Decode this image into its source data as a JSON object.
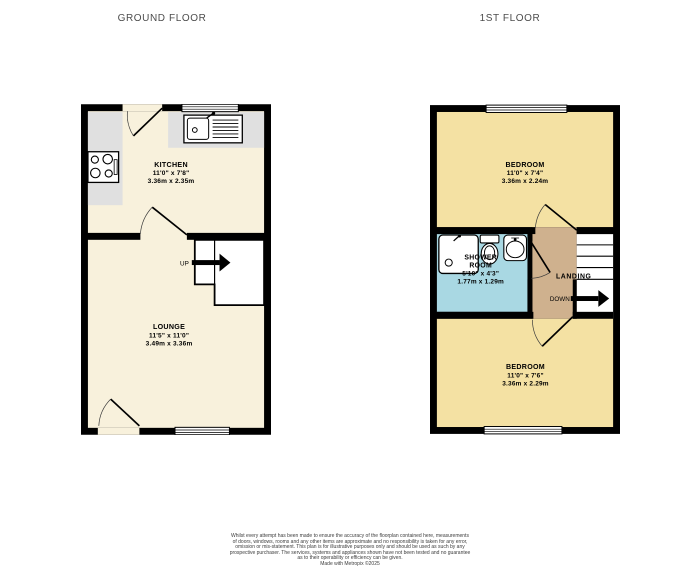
{
  "titles": {
    "ground_floor": "GROUND FLOOR",
    "first_floor": "1ST FLOOR"
  },
  "ground_floor": {
    "kitchen": {
      "name": "KITCHEN",
      "imperial": "11'0\" x 7'8\"",
      "metric": "3.36m x 2.35m"
    },
    "lounge": {
      "name": "LOUNGE",
      "imperial": "11'5\" x 11'0\"",
      "metric": "3.49m x 3.36m"
    },
    "stair_direction": "UP"
  },
  "first_floor": {
    "bedroom_top": {
      "name": "BEDROOM",
      "imperial": "11'0\" x 7'4\"",
      "metric": "3.36m x 2.24m"
    },
    "shower_room": {
      "line1": "SHOWER",
      "line2": "ROOM",
      "imperial": "5'10\" x 4'3\"",
      "metric": "1.77m x 1.29m"
    },
    "bedroom_bottom": {
      "name": "BEDROOM",
      "imperial": "11'0\" x 7'6\"",
      "metric": "3.36m x 2.29m"
    },
    "landing_label": "LANDING",
    "stair_direction": "DOWN"
  },
  "colors": {
    "wall": "#000000",
    "floor_cream": "#f8f1dc",
    "floor_yellow": "#f4e1a3",
    "floor_blue": "#a9d8e3",
    "floor_tan": "#cfb18e",
    "counter_gray": "#e0e0e0",
    "title_text": "#4c4c4c"
  },
  "disclaimer": {
    "lines": [
      "Whilst every attempt has been made to ensure the accuracy of the floorplan contained here, measurements",
      "of doors, windows, rooms and any other items are approximate and no responsibility is taken for any error,",
      "omission or mis-statement. This plan is for illustrative purposes only and should be used as such by any",
      "prospective purchaser. The services, systems and appliances shown have not been tested and no guarantee",
      "as to their operability or efficiency can be given.",
      "Made with Metropix ©2025"
    ]
  }
}
